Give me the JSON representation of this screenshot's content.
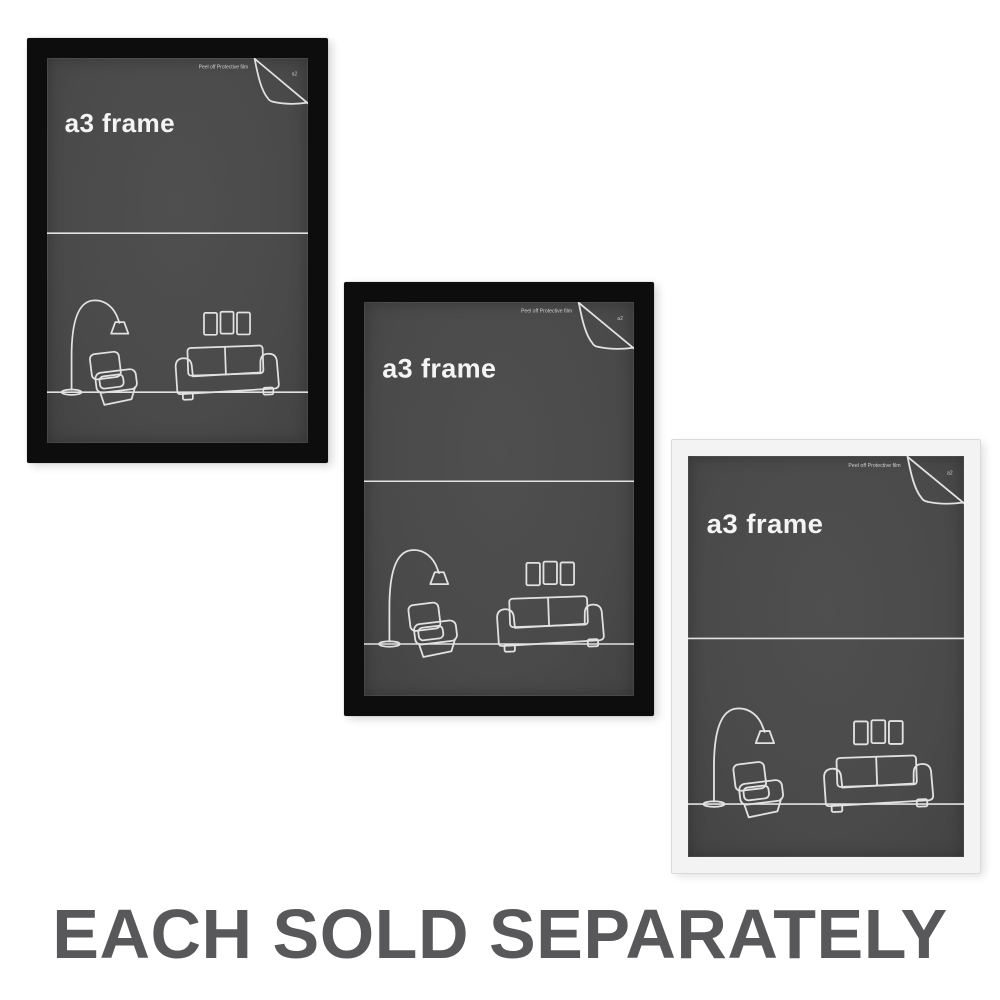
{
  "caption": {
    "text": "EACH SOLD SEPARATELY"
  },
  "insert": {
    "title": "a3 frame",
    "peel_note": "Peel off Protective film",
    "corner_label": "a2"
  },
  "frames": [
    {
      "id": "frame-1",
      "color_name": "black",
      "frame_color": "#0d0d0d"
    },
    {
      "id": "frame-2",
      "color_name": "black",
      "frame_color": "#0d0d0d"
    },
    {
      "id": "frame-3",
      "color_name": "white",
      "frame_color": "#f3f3f3"
    }
  ],
  "colors": {
    "background": "#ffffff",
    "insert_background": "#4a4a4a",
    "line_art": "#e2e2e2",
    "title_text": "#f4f4f4",
    "caption_text": "#58585a"
  }
}
